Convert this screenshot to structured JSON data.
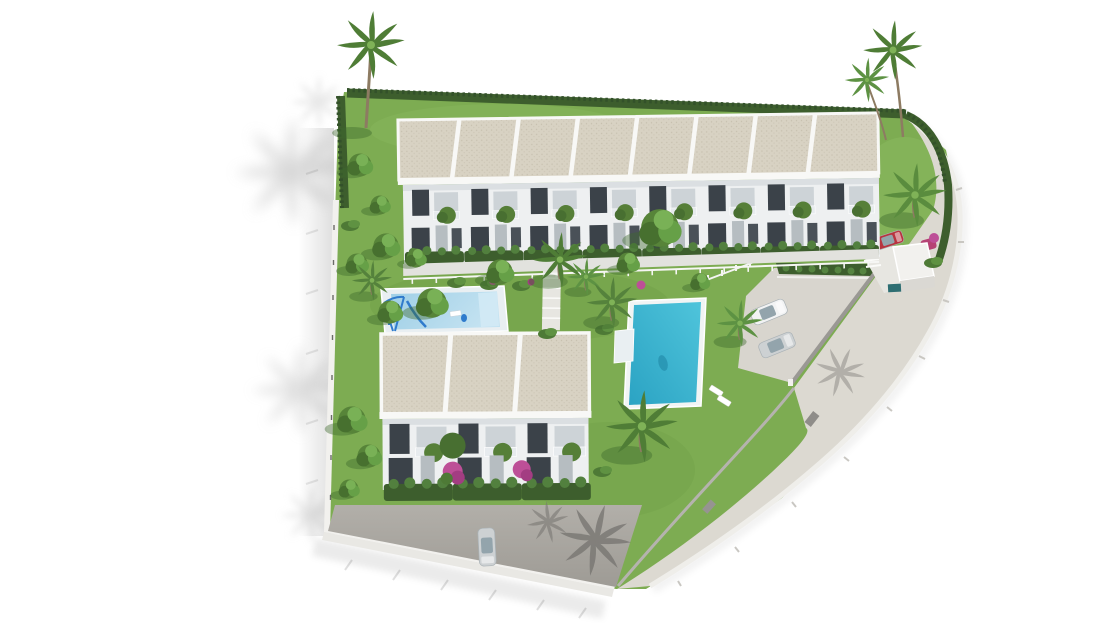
{
  "meta": {
    "type": "architectural-3d-render",
    "view": "aerial-birds-eye",
    "subject": "residential townhouse development with pools and gardens"
  },
  "scene": {
    "buildings": [
      {
        "name": "north-townhouse-row",
        "units": 8,
        "floors": 2,
        "roof": "flat-gravel"
      },
      {
        "name": "south-townhouse-block",
        "units": 3,
        "floors": 2,
        "roof": "flat-gravel"
      }
    ],
    "amenities": [
      {
        "name": "main-pool",
        "shape": "rectangular"
      },
      {
        "name": "kids-pool",
        "shape": "rectangular-shallow"
      },
      {
        "name": "playground",
        "equipment": "swing-frame-and-slide"
      },
      {
        "name": "parking-area",
        "parked_cars": 2
      },
      {
        "name": "carport",
        "parked_cars": 2
      },
      {
        "name": "perimeter-road",
        "shape": "curved"
      },
      {
        "name": "driveway",
        "parked_cars": 1
      },
      {
        "name": "stepped-garden-path"
      }
    ],
    "vegetation": [
      "palm-trees",
      "cypress-hedge",
      "round-garden-trees",
      "bougainvillea",
      "lawn"
    ],
    "cars": [
      {
        "location": "parking",
        "color_name": "white"
      },
      {
        "location": "parking",
        "color_name": "silver"
      },
      {
        "location": "carport",
        "color_name": "red"
      },
      {
        "location": "carport",
        "color_name": "magenta"
      },
      {
        "location": "driveway",
        "color_name": "silver"
      }
    ]
  },
  "colors": {
    "background": "#ffffff",
    "lawn": "#7dac52",
    "lawn_light": "#8cba60",
    "lawn_dark": "#6c9a44",
    "hedge": "#3d5e2d",
    "hedge_dark": "#33512a",
    "shrub": "#567f38",
    "shrub_light": "#6da24a",
    "tree_dark": "#486f31",
    "roof": "#d8d2c3",
    "roof_dot": "#c7c0af",
    "roof_line": "#f8f8f6",
    "facade": "#eef0f1",
    "facade_shadow": "#d6dbde",
    "window": "#3b4249",
    "window2": "#4a5158",
    "door": "#b6bdc1",
    "balcony": "#cdd3d7",
    "railing": "#e7ebee",
    "walkway": "#e2e2de",
    "path": "#e7e6e1",
    "road": "#dcd9d1",
    "road_wall": "#efeeea",
    "parking": "#d8d5ce",
    "driveway_top": "#b2afa9",
    "driveway_bot": "#9e9b95",
    "wall": "#f2f1ee",
    "wall_face": "#e9e8e4",
    "wall_dark": "#9a9894",
    "pool_light": "#4fc4db",
    "pool_deep": "#2ba3c3",
    "kids_pool_light": "#c3e2f1",
    "kids_pool": "#9fcfe6",
    "deck": "#e9eff2",
    "playground": "#2f7bcc",
    "flower": "#bd4f97",
    "flower_dark": "#a33d82",
    "trunk": "#8d7b62",
    "car_white": "#f2f3f4",
    "car_silver": "#cdd1d3",
    "car_red": "#b8333f",
    "car_magenta": "#b33a6f",
    "teal_box": "#2e6e72",
    "shadow_soft": "#cfcfcf",
    "shadow_drive": "#75736f",
    "shadow_park": "#9c9a95"
  }
}
